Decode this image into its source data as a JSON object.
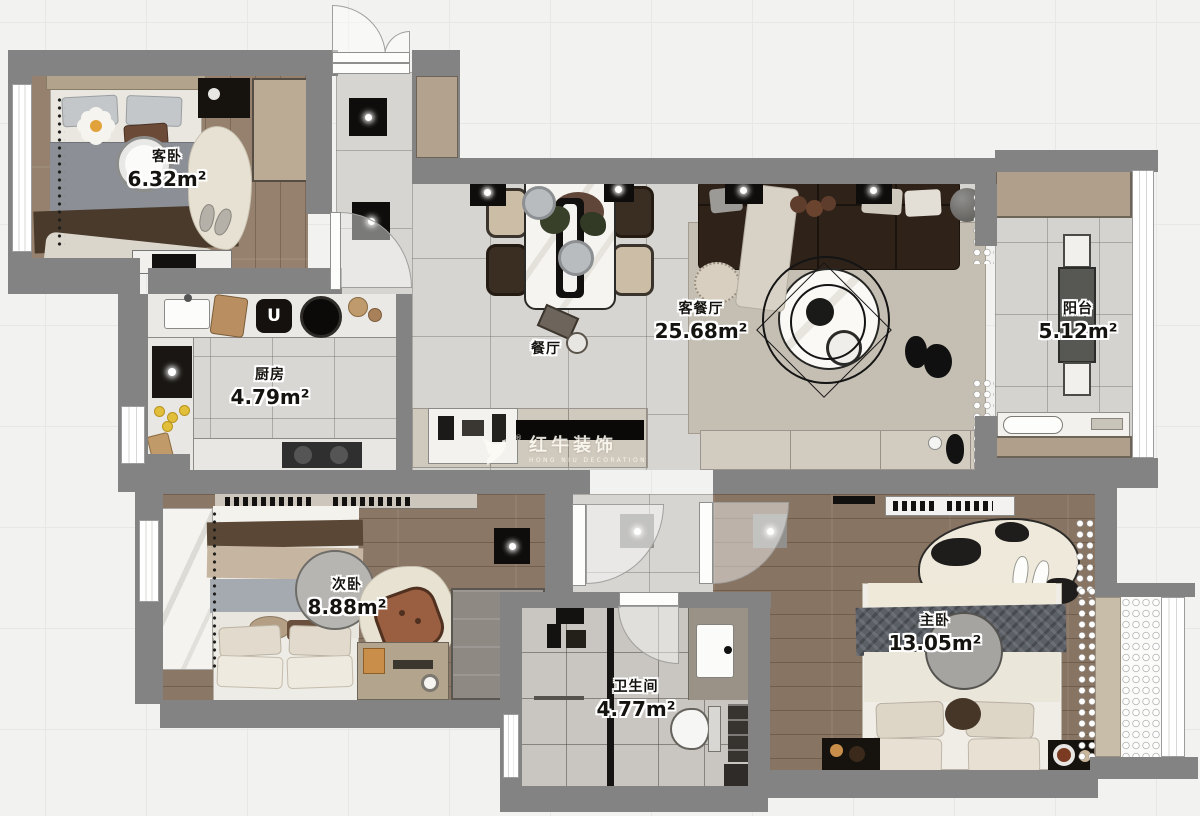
{
  "rooms": [
    {
      "id": "guest-bedroom",
      "name": "客卧",
      "area": "6.32m²"
    },
    {
      "id": "kitchen",
      "name": "厨房",
      "area": "4.79m²"
    },
    {
      "id": "dining",
      "name": "餐厅",
      "area": ""
    },
    {
      "id": "living-dining",
      "name": "客餐厅",
      "area": "25.68m²"
    },
    {
      "id": "balcony",
      "name": "阳台",
      "area": "5.12m²"
    },
    {
      "id": "second-bedroom",
      "name": "次卧",
      "area": "8.88m²"
    },
    {
      "id": "bathroom",
      "name": "卫生间",
      "area": "4.77m²"
    },
    {
      "id": "master-bedroom",
      "name": "主卧",
      "area": "13.05m²"
    }
  ],
  "watermark": {
    "brand": "红牛装饰",
    "subtitle": "HONG NIU DECORATION",
    "reg": "®"
  },
  "kitchen": {
    "hob_symbol": "U"
  },
  "colors": {
    "wall": "#838383",
    "tile": "#d7d5d1",
    "wood": "#8b7765",
    "rug": "#c5bfb3",
    "cabinet": "#b0a08b",
    "sofa": "#2f2219",
    "background": "#f2f2f0"
  }
}
